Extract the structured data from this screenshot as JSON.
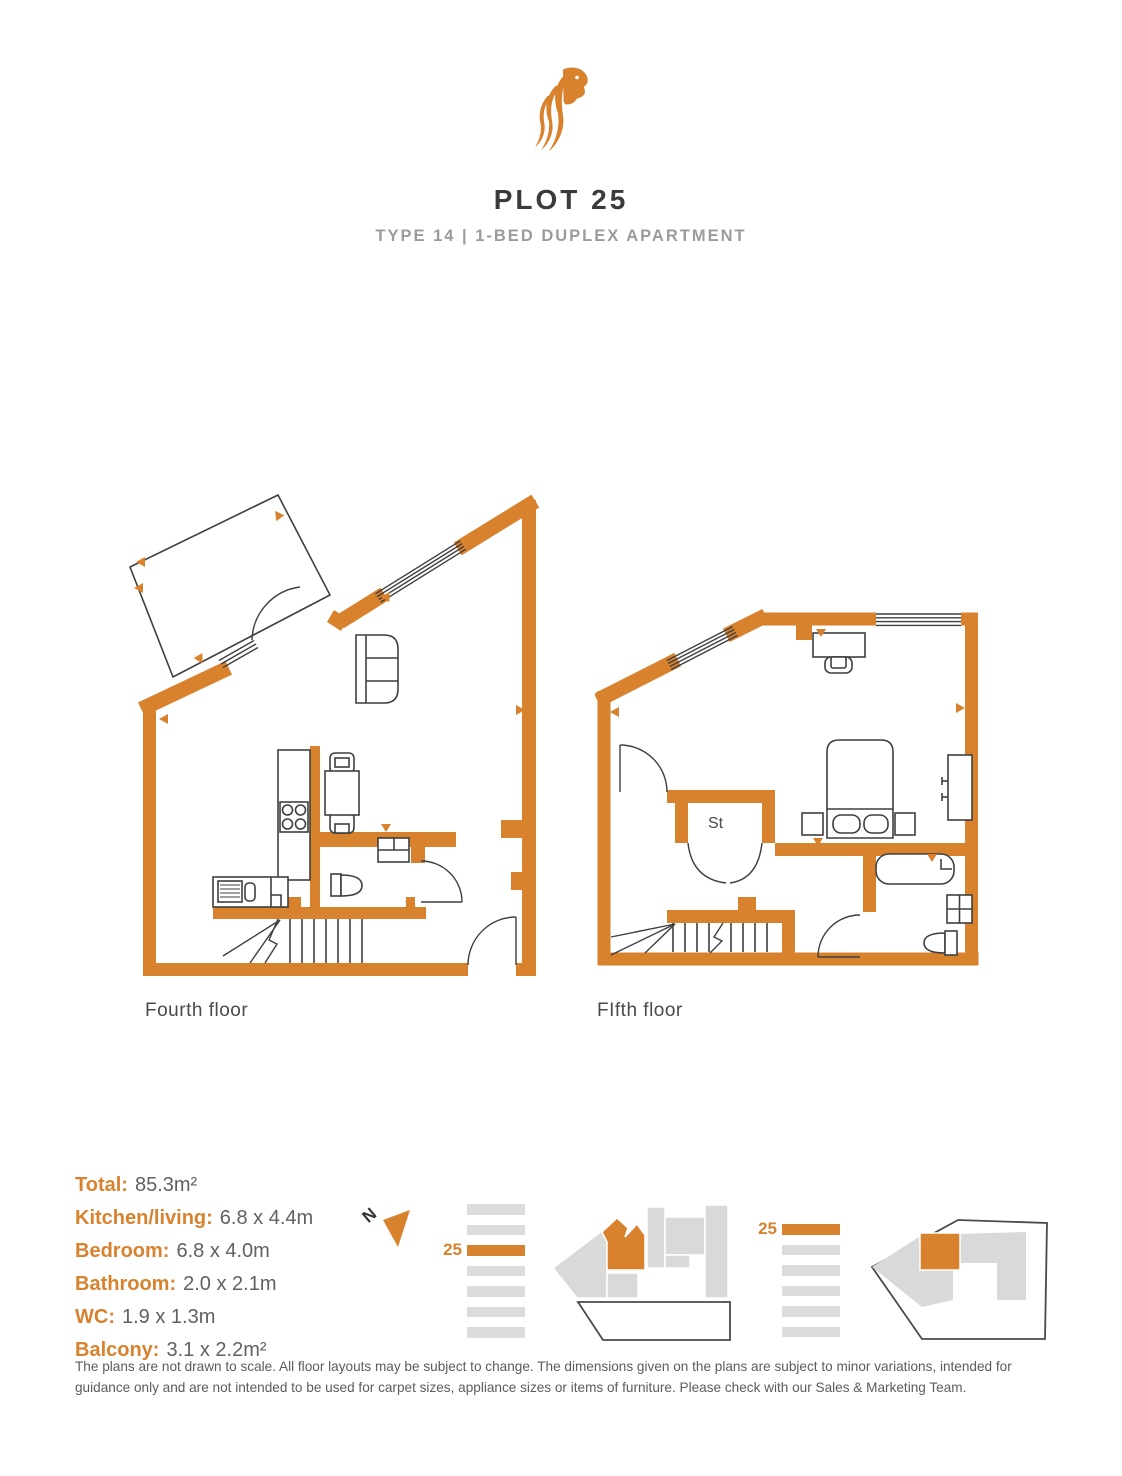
{
  "header": {
    "title": "PLOT 25",
    "subtitle": "TYPE 14 | 1-BED DUPLEX APARTMENT",
    "logo": "lion-logo"
  },
  "colors": {
    "accent": "#D9822E",
    "title_text": "#3b3b3b",
    "subtitle_text": "#9b9b9b",
    "plan_outline": "#3f3f3f",
    "site_gray": "#d9d9d9"
  },
  "floorplans": [
    {
      "label": "Fourth floor",
      "rooms": [
        "kitchen/living",
        "wc",
        "balcony",
        "stairs"
      ]
    },
    {
      "label": "FIfth floor",
      "rooms": [
        "bedroom",
        "bathroom",
        "storage",
        "stairs"
      ],
      "storage_label": "St"
    }
  ],
  "details": [
    {
      "label": "Total:",
      "value": "85.3m²"
    },
    {
      "label": "Kitchen/living:",
      "value": "6.8 x 4.4m"
    },
    {
      "label": "Bedroom:",
      "value": "6.8 x 4.0m"
    },
    {
      "label": "Bathroom:",
      "value": "2.0 x 2.1m"
    },
    {
      "label": "WC:",
      "value": "1.9 x 1.3m"
    },
    {
      "label": "Balcony:",
      "value": "3.1 x 2.2m²"
    }
  ],
  "site": {
    "north_label": "N",
    "stacks": [
      {
        "plot_label": "25",
        "bars": 7,
        "highlight": 2
      },
      {
        "plot_label": "25",
        "bars": 6,
        "highlight": 0
      }
    ]
  },
  "disclaimer": "The plans are not drawn to scale. All floor layouts may be subject to change. The dimensions given on the plans are subject to minor variations, intended for guidance only and are not intended to be used for carpet sizes, appliance sizes or items of furniture. Please check with our Sales & Marketing Team."
}
